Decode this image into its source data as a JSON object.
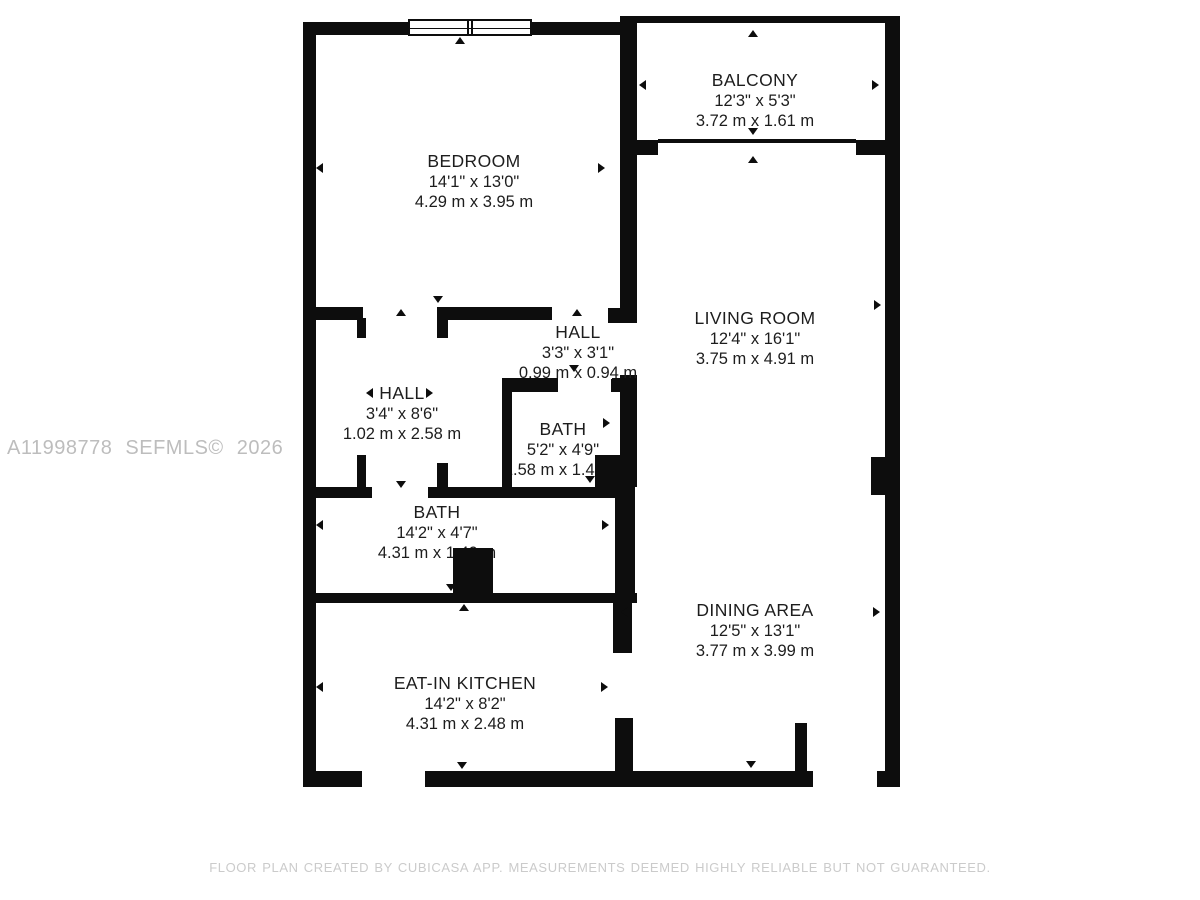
{
  "watermark": "A11998778 SEFMLS© 2026",
  "footer": "FLOOR PLAN CREATED BY CUBICASA APP. MEASUREMENTS DEEMED HIGHLY RELIABLE BUT NOT GUARANTEED.",
  "colors": {
    "wall": "#0d0d0d",
    "label_text": "#1d1d1d",
    "watermark": "#bdbdbd",
    "footer": "#cbcbcb"
  },
  "rooms": [
    {
      "name": "BEDROOM",
      "imperial": "14'1\" x 13'0\"",
      "metric": "4.29 m x 3.95 m"
    },
    {
      "name": "BALCONY",
      "imperial": "12'3\" x 5'3\"",
      "metric": "3.72 m x 1.61 m"
    },
    {
      "name": "LIVING ROOM",
      "imperial": "12'4\" x 16'1\"",
      "metric": "3.75 m x 4.91 m"
    },
    {
      "name": "HALL",
      "imperial": "3'3\" x 3'1\"",
      "metric": "0.99 m x 0.94 m"
    },
    {
      "name": "HALL",
      "imperial": "3'4\" x 8'6\"",
      "metric": "1.02 m x 2.58 m"
    },
    {
      "name": "BATH",
      "imperial": "5'2\" x 4'9\"",
      "metric": "1.58 m x 1.44 m"
    },
    {
      "name": "BATH",
      "imperial": "14'2\" x 4'7\"",
      "metric": "4.31 m x 1.40 m"
    },
    {
      "name": "DINING AREA",
      "imperial": "12'5\" x 13'1\"",
      "metric": "3.77 m x 3.99 m"
    },
    {
      "name": "EAT-IN KITCHEN",
      "imperial": "14'2\" x 8'2\"",
      "metric": "4.31 m x 2.48 m"
    }
  ]
}
